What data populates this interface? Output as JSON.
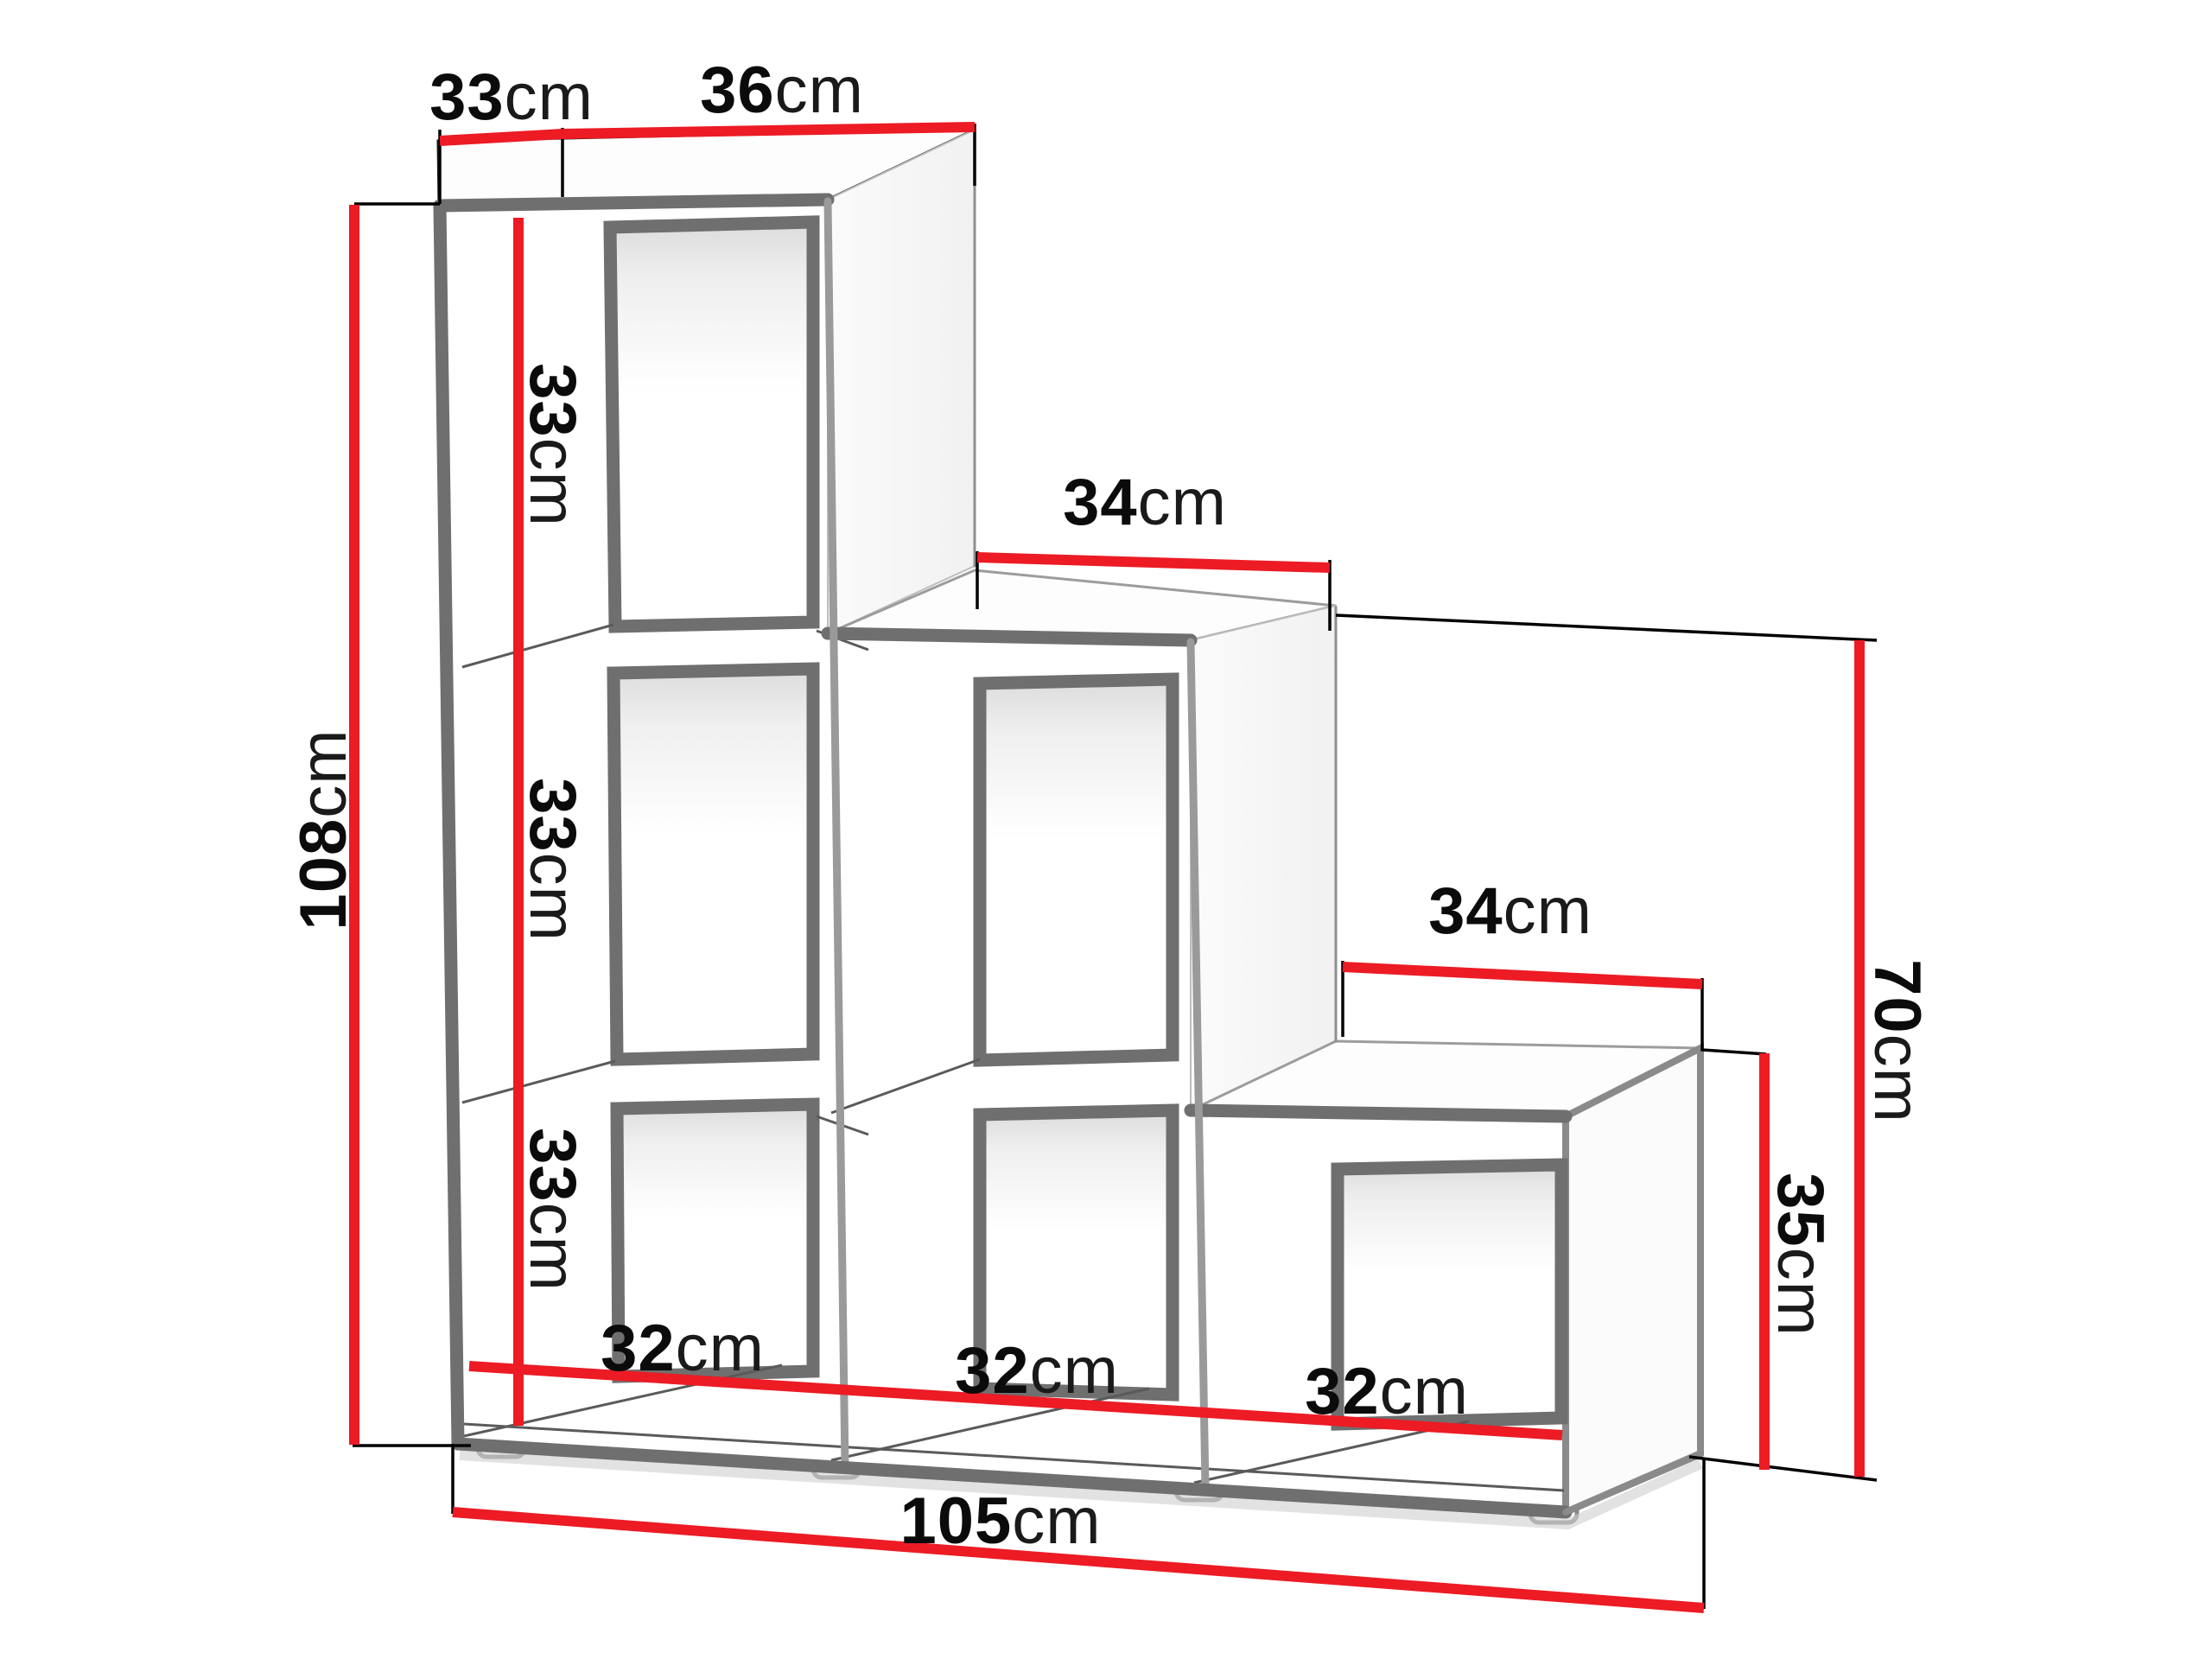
{
  "diagram": {
    "title": "step bookcase dimension diagram",
    "unit": "cm",
    "accent_color": "#ec1b24",
    "edge_color": "#6f6f6f",
    "labels": {
      "top_depth": {
        "value": "33",
        "unit": "cm"
      },
      "top_width": {
        "value": "36",
        "unit": "cm"
      },
      "height_total": {
        "value": "108",
        "unit": "cm"
      },
      "cell_height_1": {
        "value": "33",
        "unit": "cm"
      },
      "cell_height_2": {
        "value": "33",
        "unit": "cm"
      },
      "cell_height_3": {
        "value": "33",
        "unit": "cm"
      },
      "step_width_middle": {
        "value": "34",
        "unit": "cm"
      },
      "step_width_right": {
        "value": "34",
        "unit": "cm"
      },
      "height_right_column": {
        "value": "70",
        "unit": "cm"
      },
      "height_right_step": {
        "value": "35",
        "unit": "cm"
      },
      "cell_width_1": {
        "value": "32",
        "unit": "cm"
      },
      "cell_width_2": {
        "value": "32",
        "unit": "cm"
      },
      "cell_width_3": {
        "value": "32",
        "unit": "cm"
      },
      "width_total": {
        "value": "105",
        "unit": "cm"
      }
    }
  }
}
